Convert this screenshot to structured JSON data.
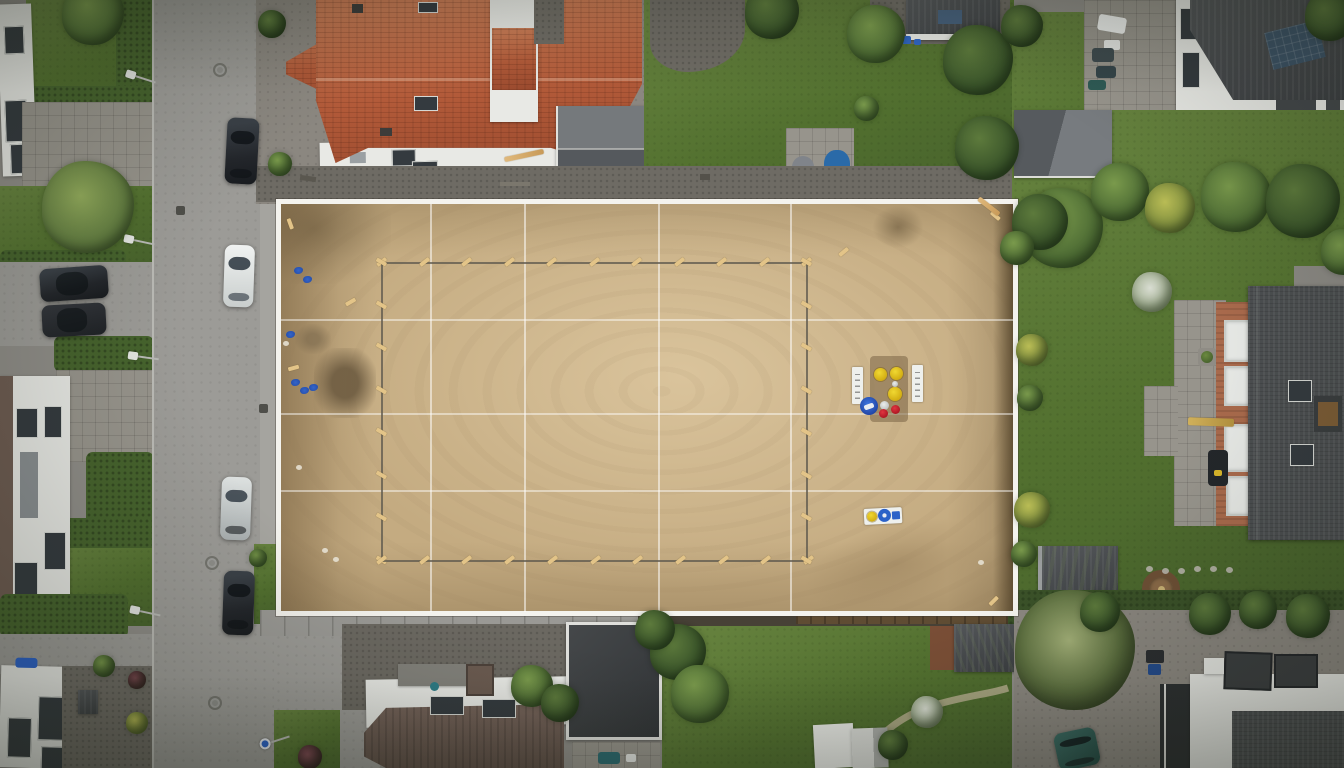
{
  "meta": {
    "title": "Overhead drone photo: suburban street with graded sand construction plot",
    "view": "top-down aerial"
  },
  "colors": {
    "asphalt": "#9c9b97",
    "pavers": "#97948c",
    "gravel": "#6e6b64",
    "sand": "#c4ab81",
    "sand_dark": "#6f5e45",
    "plot_border": "#f4f3ee",
    "stake_wood": "#e3c488",
    "grass": "#52702f",
    "grass_light": "#688440",
    "grass_dark": "#3a5128",
    "hedge": "#46632d",
    "red_roof": "#b25a39",
    "red_roof_light": "#c97a54",
    "dark_roof": "#3b3e41",
    "shingle": "#4b4e50",
    "white_wall": "#e8e9e5",
    "brick": "#a96a4c",
    "brown_roof": "#6e5c52",
    "blue_marker": "#2e63cf",
    "yellow_item": "#cfa90f",
    "red_item": "#a81420",
    "blue_item": "#2b62c8",
    "teal": "#234842",
    "car_dark": "#23262b",
    "car_white": "#f0f2f1",
    "car_silver": "#dde1e0",
    "fire_pit": "#6d4f35"
  },
  "scene": {
    "setting": "residential neighborhood, overcast daylight",
    "construction_plot": {
      "surface": "graded sand",
      "boundary": "white painted outline band",
      "grid": "white string lines dividing the plot",
      "footprint": "staked survey rectangle with wooden pegs",
      "markings": [
        "blue spray-paint dots",
        "dark excavated soil patch",
        "loose wood stakes and planks"
      ],
      "equipment_station": [
        "two white marker boards",
        "three yellow lids",
        "blue bucket",
        "white lid",
        "two red lids"
      ],
      "hose_board": [
        "yellow reel",
        "blue reel",
        "blue box"
      ]
    },
    "street": {
      "position": "left side, vertical",
      "features": [
        "manhole covers",
        "drain grates",
        "street lamps",
        "blue round sign",
        "parked cars"
      ]
    },
    "surroundings": [
      "red tile-roof house",
      "gray gable garage",
      "white flat-roof houses",
      "red brick house with large dark roof",
      "hedged front yards",
      "lawns with trees",
      "garden sheds",
      "fire pit",
      "stone patios"
    ],
    "sprites": {
      "trees": [
        [
          93,
          14,
          62,
          "mid"
        ],
        [
          88,
          207,
          92,
          "light"
        ],
        [
          272,
          24,
          28,
          "dark"
        ],
        [
          280,
          164,
          24,
          "mid"
        ],
        [
          772,
          12,
          54,
          "dark"
        ],
        [
          876,
          34,
          58,
          "mid"
        ],
        [
          866,
          108,
          25,
          "mid"
        ],
        [
          978,
          60,
          70,
          "dark"
        ],
        [
          987,
          148,
          64,
          "dark"
        ],
        [
          1022,
          26,
          42,
          "dark"
        ],
        [
          1330,
          16,
          50,
          "dark"
        ],
        [
          1063,
          228,
          80,
          "mid"
        ],
        [
          1120,
          192,
          58,
          "mid"
        ],
        [
          1170,
          208,
          50,
          "yellow"
        ],
        [
          1236,
          197,
          70,
          "mid"
        ],
        [
          1303,
          201,
          74,
          "dark"
        ],
        [
          1344,
          252,
          46,
          "mid"
        ],
        [
          1152,
          292,
          40,
          "pale"
        ],
        [
          1032,
          350,
          32,
          "yellow"
        ],
        [
          1030,
          398,
          26,
          "mid"
        ],
        [
          1032,
          510,
          36,
          "yellow"
        ],
        [
          1024,
          554,
          26,
          "mid"
        ],
        [
          1040,
          222,
          56,
          "dark"
        ],
        [
          1017,
          248,
          34,
          "mid"
        ],
        [
          678,
          652,
          56,
          "dark"
        ],
        [
          700,
          694,
          58,
          "mid"
        ],
        [
          655,
          630,
          40,
          "dark"
        ],
        [
          1075,
          650,
          120,
          "sparse"
        ],
        [
          927,
          712,
          32,
          "pale"
        ],
        [
          532,
          686,
          42,
          "mid"
        ],
        [
          560,
          703,
          38,
          "dark"
        ],
        [
          104,
          666,
          22,
          "mid"
        ],
        [
          137,
          680,
          18,
          "purple"
        ],
        [
          137,
          723,
          22,
          "yellow"
        ],
        [
          310,
          757,
          24,
          "purple"
        ],
        [
          893,
          745,
          30,
          "dark"
        ],
        [
          258,
          558,
          18,
          "mid"
        ],
        [
          1210,
          614,
          42,
          "dark"
        ],
        [
          1258,
          610,
          38,
          "dark"
        ],
        [
          1308,
          616,
          44,
          "dark"
        ],
        [
          1100,
          612,
          40,
          "dark"
        ]
      ],
      "cars": [
        [
          226,
          118,
          32,
          66,
          3,
          "dark",
          "v"
        ],
        [
          224,
          245,
          30,
          62,
          2,
          "white",
          "v"
        ],
        [
          40,
          267,
          68,
          33,
          -4,
          "dark",
          "h"
        ],
        [
          42,
          304,
          64,
          32,
          -3,
          "dark2",
          "h"
        ],
        [
          221,
          477,
          30,
          63,
          2,
          "silver",
          "v"
        ],
        [
          223,
          571,
          31,
          64,
          2,
          "dark",
          "v"
        ],
        [
          1056,
          730,
          42,
          38,
          -12,
          "teal",
          "v"
        ]
      ],
      "manholes": [
        [
          213,
          63
        ],
        [
          205,
          556
        ],
        [
          208,
          696
        ]
      ],
      "drains": [
        [
          176,
          206
        ],
        [
          259,
          404
        ]
      ],
      "lamps": [
        [
          126,
          68,
          18,
          0
        ],
        [
          124,
          233,
          12,
          0
        ],
        [
          128,
          350,
          8,
          0
        ],
        [
          130,
          604,
          12,
          0
        ],
        [
          260,
          741,
          -18,
          1
        ]
      ],
      "grid_v": [
        430,
        524,
        658,
        790
      ],
      "grid_h": [
        319,
        413,
        490
      ],
      "survey_lines": [
        [
          381,
          262,
          806,
          262,
          11,
          -38
        ],
        [
          381,
          262,
          381,
          560,
          8,
          30
        ],
        [
          381,
          560,
          808,
          560,
          11,
          -38
        ],
        [
          806,
          262,
          806,
          560,
          8,
          30
        ]
      ],
      "loose_stakes": [
        [
          988,
          599,
          -45
        ],
        [
          990,
          214,
          40
        ],
        [
          285,
          222,
          70
        ],
        [
          288,
          366,
          -15
        ],
        [
          345,
          300,
          -30
        ],
        [
          838,
          250,
          -40
        ]
      ],
      "planks": [
        [
          976,
          204,
          26,
          38
        ],
        [
          504,
          153,
          40,
          -12
        ]
      ],
      "blue_marks": [
        [
          294,
          267
        ],
        [
          303,
          276
        ],
        [
          291,
          379
        ],
        [
          300,
          387
        ],
        [
          309,
          384
        ],
        [
          286,
          331
        ]
      ],
      "pebbles": [
        [
          322,
          548
        ],
        [
          333,
          557
        ],
        [
          283,
          341
        ],
        [
          296,
          465
        ],
        [
          978,
          560
        ]
      ],
      "stones": [
        [
          1146,
          566
        ],
        [
          1162,
          568
        ],
        [
          1178,
          568
        ],
        [
          1194,
          566
        ],
        [
          1210,
          566
        ],
        [
          1226,
          567
        ]
      ]
    }
  }
}
